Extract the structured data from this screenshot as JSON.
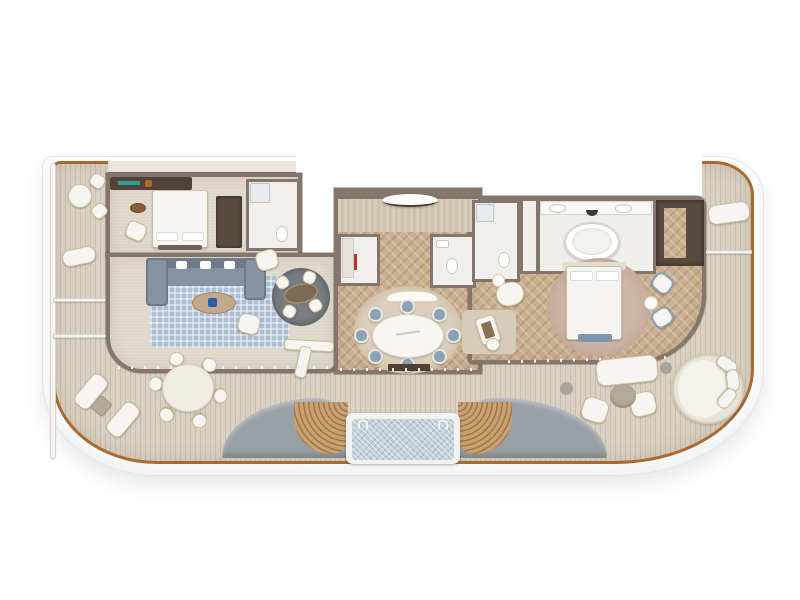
{
  "scene": {
    "kind": "floor-plan-render",
    "view": "top-down",
    "subject": "ship-suite-with-wraparound-deck",
    "canvas": {
      "width": 800,
      "height": 600
    },
    "visible_text": []
  },
  "palette": {
    "bg": "#ffffff",
    "hull": "#fcfdfe",
    "hullLine": "#e2e4e7",
    "teak": "#a96a2f",
    "deck": "#d9d1c2",
    "wall": "#84766a",
    "wallDark": "#6f6152",
    "carpet": "#ded7ca",
    "wood": "#c9ae90",
    "rugBlue": "#aabdd2",
    "rugDining": "#dacfbb",
    "rugPink": "#ccb4a6",
    "rugDesk": "#d6ccb9",
    "sofa": "#8793a1",
    "sofaBack": "#6e7a88",
    "chairBlue": "#8ba1b6",
    "furn": "#f6f5f1",
    "furnTrim": "#cbbd9a",
    "bath": "#f1efeb",
    "closet": "#594c3f",
    "pool": "#c3d0d9",
    "poolFrame": "#f2f2f0",
    "sculpt": "#9aa0a5",
    "stairA": "#caa173",
    "stairB": "#9e7748",
    "ottoman": "#b4aa99",
    "accentRed": "#b5352a",
    "accentTeal": "#2aa198",
    "bench": "#7e97b1",
    "stripeA": "#d8cdbb",
    "stripeB": "#cdc2ae"
  },
  "rooms": [
    {
      "name": "port-bedroom",
      "furniture": [
        "double-bed",
        "wardrobe",
        "vanity-desk",
        "armchair",
        "pouf",
        "ensuite-shower-room"
      ]
    },
    {
      "name": "living-room",
      "furniture": [
        "l-shaped-sectional-sofa",
        "blue-area-rug",
        "oval-coffee-table",
        "two-swivel-armchairs",
        "circular-lounge-with-oval-table-and-four-chairs",
        "bar-counter"
      ]
    },
    {
      "name": "entrance-foyer",
      "furniture": [
        "curved-entry-console",
        "striped-plank-floor"
      ]
    },
    {
      "name": "pantry",
      "furniture": [
        "minibar-red",
        "cabinets"
      ]
    },
    {
      "name": "guest-bathroom",
      "furniture": [
        "toilet",
        "sink"
      ]
    },
    {
      "name": "shower-room",
      "furniture": [
        "shower",
        "toilet"
      ]
    },
    {
      "name": "dining-room",
      "furniture": [
        "oval-marble-table",
        "eight-blue-chairs",
        "round-rug",
        "curved-console",
        "tv-cabinet"
      ]
    },
    {
      "name": "master-bathroom",
      "furniture": [
        "freestanding-oval-tub",
        "double-vanity-two-sinks",
        "partition-wall"
      ]
    },
    {
      "name": "walk-in-closet",
      "furniture": [
        "dark-cabinetry"
      ]
    },
    {
      "name": "master-bedroom",
      "furniture": [
        "king-bed",
        "round-pink-rug",
        "foot-bench",
        "two-blue-armchairs",
        "round-side-table",
        "reading-chair",
        "writing-desk",
        "desk-chair",
        "desk-rug"
      ]
    },
    {
      "name": "port-balcony",
      "furniture": [
        "round-table",
        "two-chairs",
        "lounger",
        "privacy-dividers"
      ]
    },
    {
      "name": "starboard-balcony",
      "furniture": [
        "lounger",
        "privacy-divider"
      ]
    },
    {
      "name": "aft-deck",
      "furniture": [
        "round-outdoor-dining-table",
        "six-outdoor-chairs",
        "two-sun-loungers",
        "side-table",
        "plunge-pool",
        "pool-ladders",
        "curved-gray-sculpt-walls",
        "curved-teak-stairs-left",
        "curved-teak-stairs-right",
        "outdoor-sofa",
        "two-outdoor-armchairs",
        "round-ottoman",
        "round-daybed",
        "side-tables"
      ]
    }
  ]
}
